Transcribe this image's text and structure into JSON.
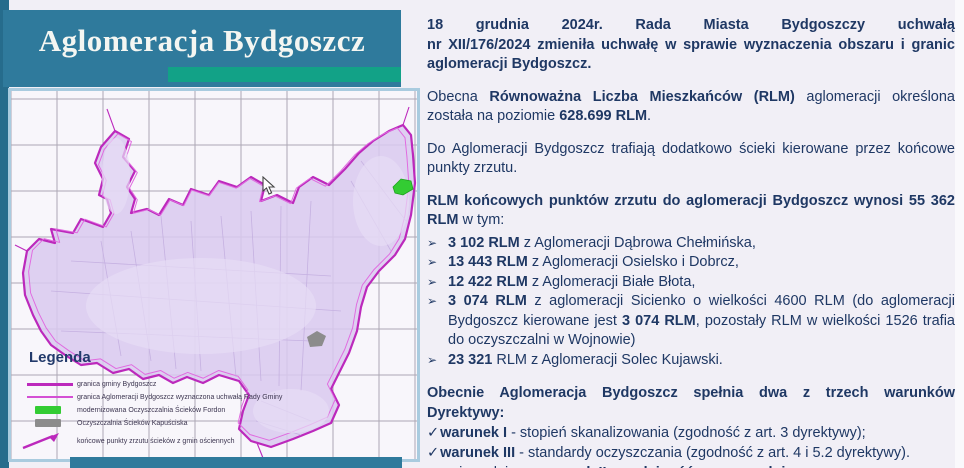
{
  "slide": {
    "title": "Aglomeracja Bydgoszcz"
  },
  "colors": {
    "banner_teal": "#2F7A9C",
    "accent_green": "#12A287",
    "text_navy": "#1F3864",
    "boundary_magenta": "#BC29BC",
    "urban_fill": "#D5C3EB",
    "plant_fordon_green": "#33CC33",
    "plant_kapusciska_gray": "#8C8C8C"
  },
  "intro": {
    "p1_line1": "18 grudnia 2024r. Rada Miasta Bydgoszczy uchwałą",
    "p1_rest": "nr XII/176/2024 zmieniła uchwałę w sprawie wyznaczenia obszaru i granic aglomeracji Bydgoszcz.",
    "p2_r1": "Obecna ",
    "p2_b1": "Równoważna Liczba Mieszkańców (RLM)",
    "p2_r2": " aglomeracji określona została na poziomie ",
    "p2_b2": "628.699 RLM",
    "p2_r3": ".",
    "p3": "Do Aglomeracji Bydgoszcz trafiają dodatkowo ścieki kierowane przez końcowe punkty zrzutu.",
    "p4_bold": "RLM końcowych punktów zrzutu do aglomeracji Bydgoszcz wynosi 55 362 RLM",
    "p4_rest": " w tym:"
  },
  "bullets": {
    "marker": "➢",
    "items": [
      {
        "b1": "3 102 RLM",
        "r1": " z Aglomeracji Dąbrowa Chełmińska,"
      },
      {
        "b1": "13 443 RLM",
        "r1": " z Aglomeracji Osielsko i Dobrcz,"
      },
      {
        "b1": "12 422 RLM",
        "r1": " z Aglomeracji Białe Błota,"
      },
      {
        "b1": "3 074 RLM",
        "r1": " z aglomeracji Sicienko o wielkości 4600 RLM (do aglomeracji Bydgoszcz kierowane jest ",
        "b2": "3 074 RLM",
        "r2": ", pozostały RLM w wielkości 1526 trafia do oczyszczalni w Wojnowie)"
      },
      {
        "b1": "23 321",
        "r1": " RLM z Aglomeracji Solec Kujawski."
      }
    ]
  },
  "directive": {
    "heading": "Obecnie Aglomeracja Bydgoszcz spełnia dwa z trzech warunków Dyrektywy:",
    "check_marker": "✓",
    "arrow_marker": "➢",
    "items": [
      {
        "bold": "warunek I",
        "rest": " - stopień skanalizowania (zgodność z art. 3 dyrektywy);"
      },
      {
        "bold": "warunek III",
        "rest": " - standardy oczyszczania (zgodność z art. 4 i 5.2 dyrektywy)."
      },
      {
        "pre": "niespełniony ",
        "bold": "warunek II - wydajność oczyszczalni"
      }
    ]
  },
  "legend": {
    "title": "Legenda",
    "items": [
      {
        "label": "granica gminy Bydgoszcz"
      },
      {
        "label": "granica Aglomeracji Bydgoszcz wyznaczona uchwałą Rady Gminy"
      },
      {
        "label": "modernizowana Oczyszczalnia Ścieków Fordon"
      },
      {
        "label": "Oczyszczalnia Ścieków Kapuściska"
      },
      {
        "label": "końcowe punkty zrzutu ścieków z gmin ościennych"
      }
    ]
  }
}
